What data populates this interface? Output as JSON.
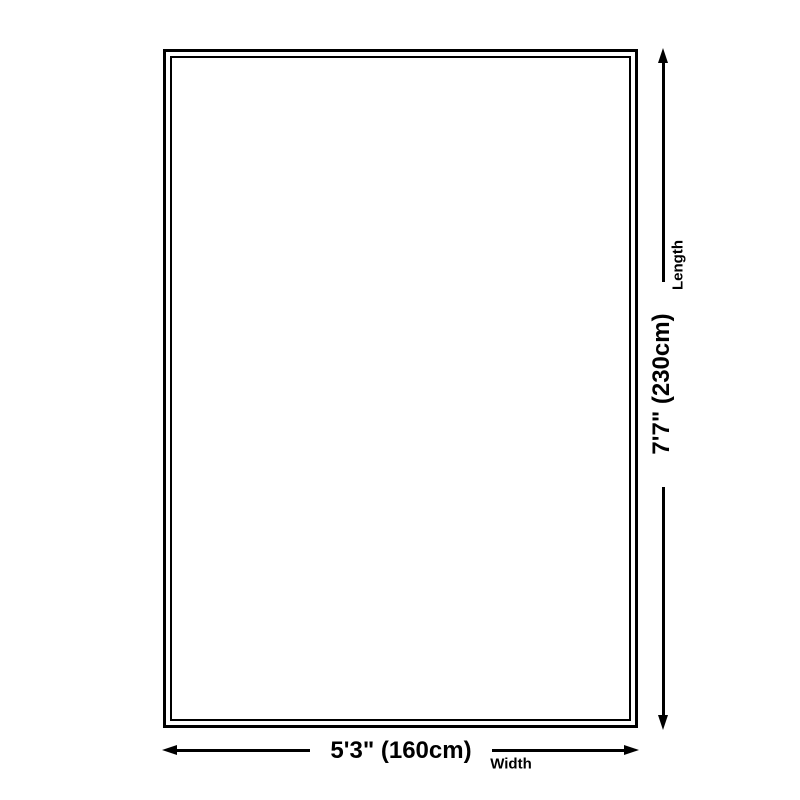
{
  "diagram": {
    "background_color": "#ffffff",
    "line_color": "#000000",
    "length_dimension": {
      "value": "7'7\" (230cm)",
      "label": "Length"
    },
    "width_dimension": {
      "value": "5'3\" (160cm)",
      "label": "Width"
    }
  }
}
